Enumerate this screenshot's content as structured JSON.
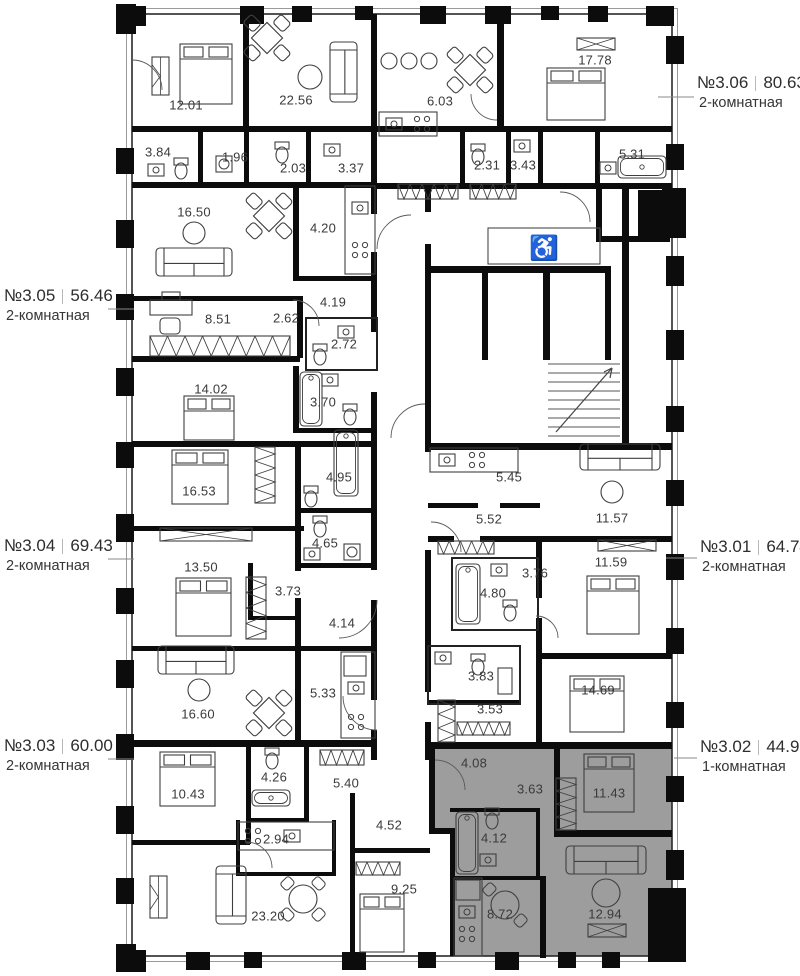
{
  "plan": {
    "highlight_color": "#9d9d9d",
    "wall_color": "#0c0c0c",
    "label_color": "#3a3a3a"
  },
  "icons": {
    "accessibility": "♿"
  },
  "apartments": [
    {
      "number": "№3.06",
      "area": "80.63",
      "type": "2-комнатная",
      "side": "right",
      "highlighted": false
    },
    {
      "number": "№3.05",
      "area": "56.46",
      "type": "2-комнатная",
      "side": "left",
      "highlighted": false
    },
    {
      "number": "№3.04",
      "area": "69.43",
      "type": "2-комнатная",
      "side": "left",
      "highlighted": false
    },
    {
      "number": "№3.03",
      "area": "60.00",
      "type": "2-комнатная",
      "side": "left",
      "highlighted": false
    },
    {
      "number": "№3.01",
      "area": "64.74",
      "type": "2-комнатная",
      "side": "right",
      "highlighted": false
    },
    {
      "number": "№3.02",
      "area": "44.92",
      "type": "1-комнатная",
      "side": "right",
      "highlighted": true
    }
  ],
  "rooms": [
    {
      "area": "12.01",
      "x": 186,
      "y": 105
    },
    {
      "area": "22.56",
      "x": 296,
      "y": 100
    },
    {
      "area": "3.84",
      "x": 158,
      "y": 152
    },
    {
      "area": "1.96",
      "x": 235,
      "y": 157
    },
    {
      "area": "2.03",
      "x": 293,
      "y": 168
    },
    {
      "area": "3.37",
      "x": 351,
      "y": 168
    },
    {
      "area": "6.03",
      "x": 440,
      "y": 101
    },
    {
      "area": "17.78",
      "x": 595,
      "y": 60
    },
    {
      "area": "2.31",
      "x": 487,
      "y": 165
    },
    {
      "area": "3.43",
      "x": 523,
      "y": 165
    },
    {
      "area": "5.31",
      "x": 632,
      "y": 154
    },
    {
      "area": "16.50",
      "x": 194,
      "y": 212
    },
    {
      "area": "4.20",
      "x": 323,
      "y": 228
    },
    {
      "area": "4.19",
      "x": 333,
      "y": 302
    },
    {
      "area": "8.51",
      "x": 218,
      "y": 319
    },
    {
      "area": "2.62",
      "x": 286,
      "y": 318
    },
    {
      "area": "2.72",
      "x": 344,
      "y": 344
    },
    {
      "area": "3.70",
      "x": 323,
      "y": 402
    },
    {
      "area": "14.02",
      "x": 211,
      "y": 389
    },
    {
      "area": "16.53",
      "x": 199,
      "y": 491
    },
    {
      "area": "4.95",
      "x": 339,
      "y": 477
    },
    {
      "area": "4.65",
      "x": 325,
      "y": 543
    },
    {
      "area": "13.50",
      "x": 201,
      "y": 567
    },
    {
      "area": "3.73",
      "x": 288,
      "y": 591
    },
    {
      "area": "4.14",
      "x": 342,
      "y": 623
    },
    {
      "area": "5.45",
      "x": 509,
      "y": 477
    },
    {
      "area": "5.52",
      "x": 489,
      "y": 519
    },
    {
      "area": "11.57",
      "x": 612,
      "y": 518
    },
    {
      "area": "11.59",
      "x": 611,
      "y": 562
    },
    {
      "area": "3.76",
      "x": 535,
      "y": 573
    },
    {
      "area": "4.80",
      "x": 493,
      "y": 593
    },
    {
      "area": "3.83",
      "x": 481,
      "y": 676
    },
    {
      "area": "3.53",
      "x": 490,
      "y": 709
    },
    {
      "area": "14.69",
      "x": 598,
      "y": 690
    },
    {
      "area": "16.60",
      "x": 198,
      "y": 714
    },
    {
      "area": "5.33",
      "x": 323,
      "y": 693
    },
    {
      "area": "10.43",
      "x": 188,
      "y": 794
    },
    {
      "area": "4.26",
      "x": 274,
      "y": 777
    },
    {
      "area": "5.40",
      "x": 346,
      "y": 783
    },
    {
      "area": "2.94",
      "x": 276,
      "y": 839
    },
    {
      "area": "23.20",
      "x": 268,
      "y": 916
    },
    {
      "area": "4.52",
      "x": 389,
      "y": 825
    },
    {
      "area": "9.25",
      "x": 404,
      "y": 889
    },
    {
      "area": "4.08",
      "x": 474,
      "y": 763
    },
    {
      "area": "3.63",
      "x": 530,
      "y": 789
    },
    {
      "area": "11.43",
      "x": 609,
      "y": 793
    },
    {
      "area": "4.12",
      "x": 494,
      "y": 838
    },
    {
      "area": "8.72",
      "x": 500,
      "y": 914
    },
    {
      "area": "12.94",
      "x": 605,
      "y": 914
    }
  ]
}
